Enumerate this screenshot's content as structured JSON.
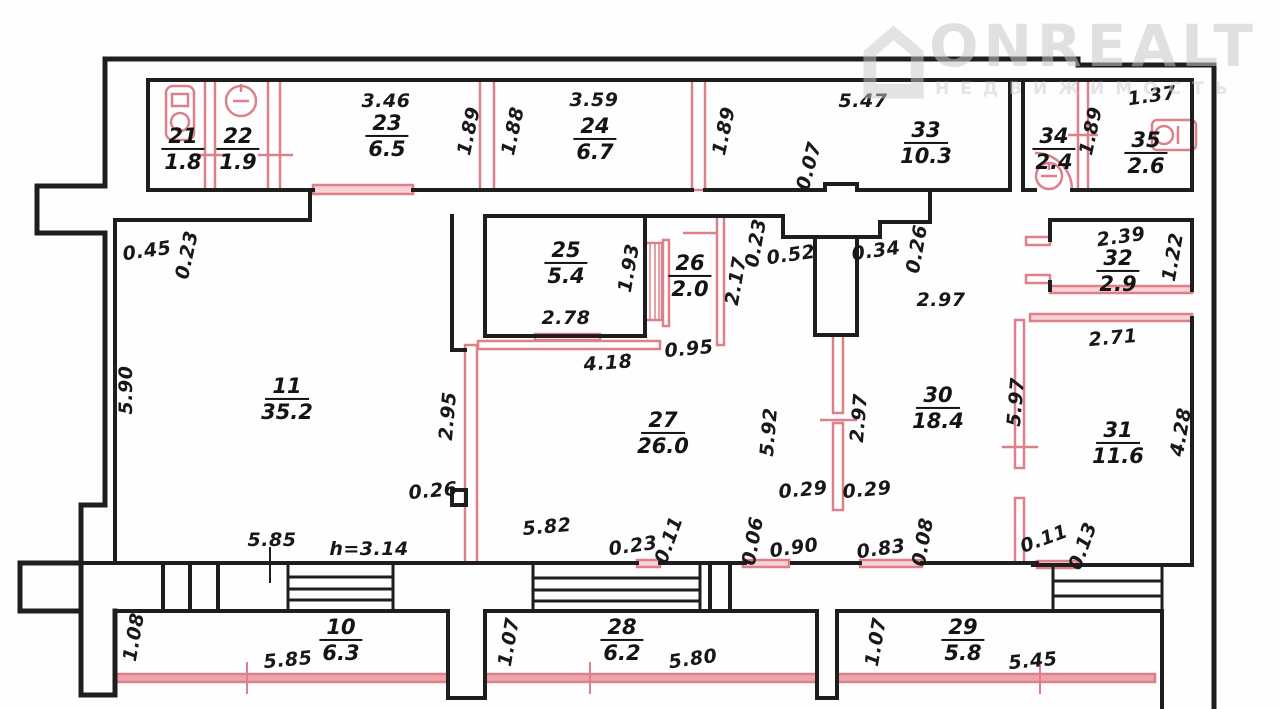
{
  "watermark": {
    "brand": "ONREALT",
    "tagline": "НЕДВИЖИМОСТЬ"
  },
  "rooms": [
    {
      "number": "21",
      "area": "1.8"
    },
    {
      "number": "22",
      "area": "1.9"
    },
    {
      "number": "23",
      "area": "6.5"
    },
    {
      "number": "24",
      "area": "6.7"
    },
    {
      "number": "33",
      "area": "10.3"
    },
    {
      "number": "34",
      "area": "2.4"
    },
    {
      "number": "35",
      "area": "2.6"
    },
    {
      "number": "25",
      "area": "5.4"
    },
    {
      "number": "26",
      "area": "2.0"
    },
    {
      "number": "32",
      "area": "2.9"
    },
    {
      "number": "11",
      "area": "35.2"
    },
    {
      "number": "27",
      "area": "26.0"
    },
    {
      "number": "30",
      "area": "18.4"
    },
    {
      "number": "31",
      "area": "11.6"
    },
    {
      "number": "10",
      "area": "6.3"
    },
    {
      "number": "28",
      "area": "6.2"
    },
    {
      "number": "29",
      "area": "5.8"
    }
  ],
  "dims": [
    "3.46",
    "1.89",
    "1.88",
    "3.59",
    "1.89",
    "5.47",
    "0.07",
    "1.37",
    "1.89",
    "0.45",
    "0.23",
    "1.93",
    "2.78",
    "4.18",
    "0.95",
    "2.17",
    "0.23",
    "0.52",
    "0.34",
    "0.26",
    "2.97",
    "2.39",
    "1.22",
    "2.71",
    "5.90",
    "2.95",
    "5.92",
    "2.97",
    "5.97",
    "4.28",
    "0.26",
    "0.29",
    "0.29",
    "5.85",
    "h=3.14",
    "5.82",
    "0.23",
    "0.11",
    "0.06",
    "0.90",
    "0.83",
    "0.08",
    "0.11",
    "0.13",
    "1.08",
    "5.85",
    "1.07",
    "5.80",
    "1.07",
    "5.45"
  ],
  "colors": {
    "wall": "#1e1e1e",
    "partition": "#dd808a",
    "text": "#181818",
    "watermark": "#c6c6c6"
  }
}
